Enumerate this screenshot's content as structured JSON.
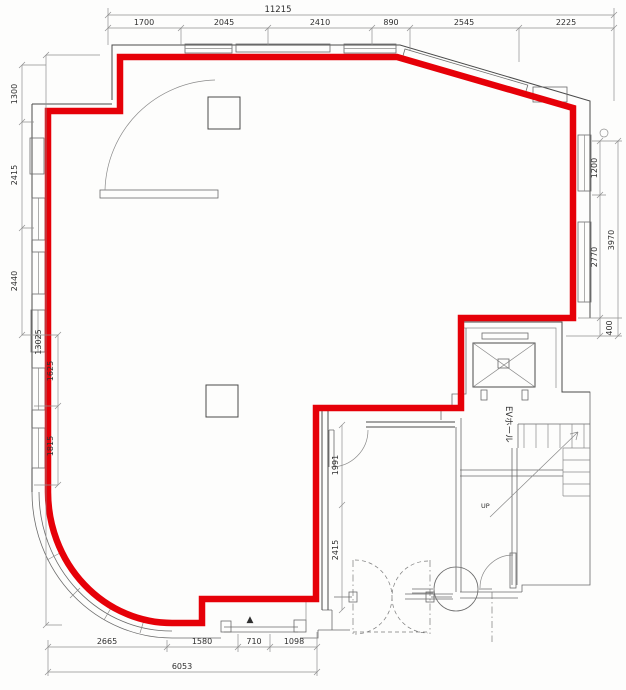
{
  "colors": {
    "lease_outline": "#e60008",
    "wall": "#4a4a4a",
    "dim_line": "#8f8f8f",
    "paper": "#fdfdfc"
  },
  "labels": {
    "ev_hall": "EVホール",
    "up": "UP",
    "entrance_marker": "▲"
  },
  "dimensions": {
    "top": {
      "total": "11215",
      "segments": [
        "1700",
        "2045",
        "2410",
        "890",
        "2545",
        "2225"
      ]
    },
    "left": {
      "total": "13025",
      "segments_upper": [
        "1300",
        "2415",
        "2440"
      ],
      "segments_lower": [
        "1625",
        "1815"
      ]
    },
    "right": {
      "total": "3970",
      "segments": [
        "1200",
        "2770",
        "400"
      ]
    },
    "bottom": {
      "total": "6053",
      "segments": [
        "2665",
        "1580",
        "710",
        "1098"
      ]
    },
    "interior": {
      "segments": [
        "1991",
        "2415"
      ]
    }
  }
}
